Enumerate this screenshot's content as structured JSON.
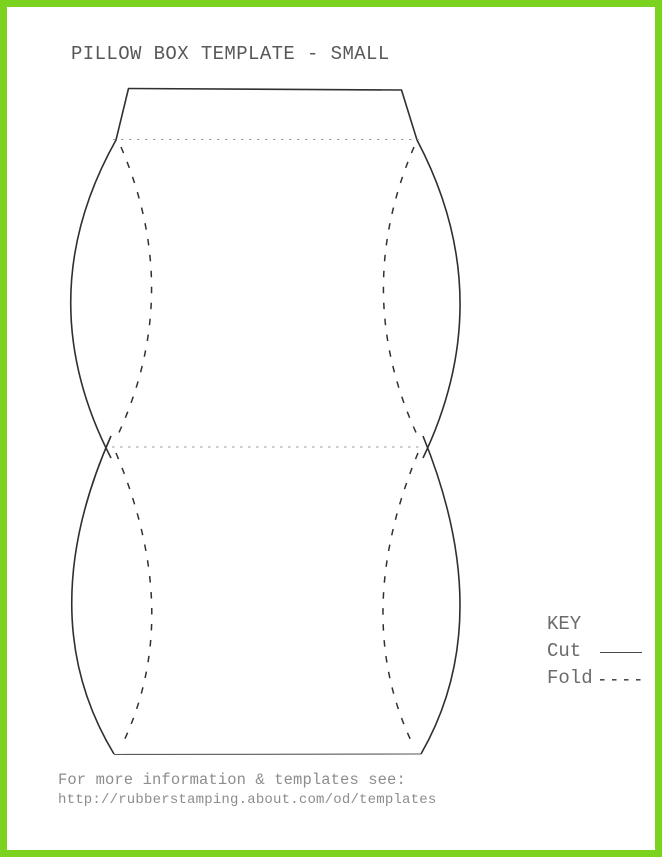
{
  "page": {
    "title": "PILLOW BOX TEMPLATE - SMALL"
  },
  "key": {
    "heading": "KEY",
    "items": [
      {
        "label": "Cut",
        "line_style": "solid"
      },
      {
        "label": "Fold",
        "line_style": "dashed"
      }
    ]
  },
  "footer": {
    "line1": "For more information & templates see:",
    "line2": "http://rubberstamping.about.com/od/templates"
  },
  "diagram": {
    "name": "pillow-box-template-outline",
    "cut_line_meaning": "solid lines are cut lines",
    "fold_line_meaning": "dashed/dotted lines are fold lines"
  },
  "colors": {
    "frame_border": "#7bd31f",
    "background": "#ffffff",
    "cut_line": "#303030",
    "fold_curve_line": "#303030",
    "fold_crease_line": "#9b9b9b",
    "title_text": "#585858",
    "key_text": "#6b6b6b",
    "footer_text": "#8d8d8d"
  }
}
